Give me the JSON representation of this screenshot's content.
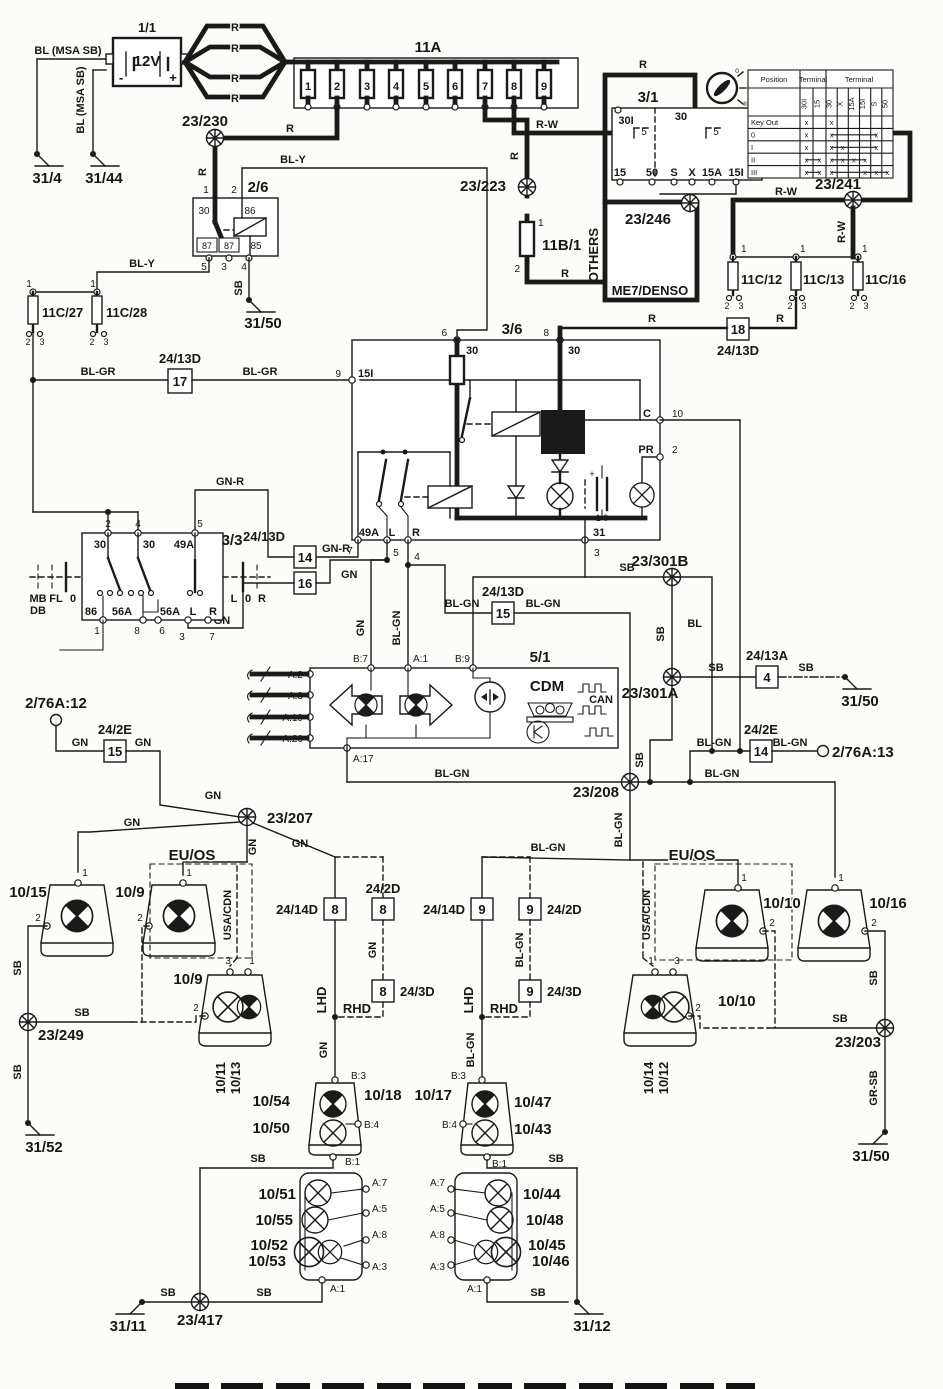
{
  "comp": {
    "battery": "1/1",
    "volt": "12V",
    "minus": "-",
    "plus": "+",
    "fusebox": "11A",
    "ign": "3/1",
    "b111": "11B/1",
    "others": "OTHERS",
    "me7": "ME7/DENSO",
    "c12": "11C/12",
    "c13": "11C/13",
    "c16": "11C/16",
    "c27": "11C/27",
    "c28": "11C/28",
    "relay": "2/6",
    "flasher": "3/6",
    "stalk": "3/3",
    "cdm_id": "5/1",
    "cdm": "CDM",
    "can": "CAN",
    "a12": "2/76A:12",
    "a13": "2/76A:13"
  },
  "w": {
    "r": "R",
    "rw": "R-W",
    "bly": "BL-Y",
    "blgr": "BL-GR",
    "gnr": "GN-R",
    "gn": "GN",
    "blgn": "BL-GN",
    "sb": "SB",
    "bl": "BL",
    "grsb": "GR-SB",
    "blmsa": "BL (MSA SB)"
  },
  "sp": {
    "s230": "23/230",
    "s223": "23/223",
    "s241": "23/241",
    "s246": "23/246",
    "s301b": "23/301B",
    "s301a": "23/301A",
    "s207": "23/207",
    "s208": "23/208",
    "s249": "23/249",
    "s203": "23/203",
    "s417": "23/417"
  },
  "g": {
    "g4": "31/4",
    "g44": "31/44",
    "g50": "31/50",
    "g52": "31/52",
    "g11": "31/11",
    "g12": "31/12"
  },
  "cn": {
    "c2413d": "24/13D",
    "c2413a": "24/13A",
    "c242e": "24/2E",
    "c2414d": "24/14D",
    "c242d": "24/2D",
    "c243d": "24/3D",
    "p4": "4",
    "p8": "8",
    "p9": "9",
    "p14": "14",
    "p15": "15",
    "p16": "16",
    "p17": "17",
    "p18": "18"
  },
  "pn": {
    "n1": "1",
    "n2": "2",
    "n3": "3",
    "n4": "4",
    "n5": "5",
    "n6": "6",
    "n7": "7",
    "n8": "8",
    "n9": "9",
    "n10": "10",
    "n30": "30",
    "n31": "31",
    "n86": "86",
    "n87": "87",
    "n85": "85",
    "n49a": "49A",
    "n56a": "56A",
    "n15i": "15I",
    "l": "L",
    "r": "R",
    "c": "C",
    "pr": "PR",
    "cap": "1 0",
    "mb": "MB",
    "db": "DB",
    "fl": "FL",
    "zero": "0"
  },
  "cdmp": {
    "a1": "A:1",
    "a2": "A:2",
    "a3": "A:3",
    "a19": "A:19",
    "a20": "A:20",
    "b7": "B:7",
    "b9": "B:9",
    "a17": "A:17",
    "b3": "B:3",
    "b4": "B:4",
    "b1": "B:1",
    "a5": "A:5",
    "a7": "A:7",
    "a8": "A:8"
  },
  "lp": {
    "l1015": "10/15",
    "l109": "10/9",
    "l1011": "10/11",
    "l1013": "10/13",
    "l1010": "10/10",
    "l1016": "10/16",
    "l1014": "10/14",
    "l1012": "10/12",
    "l1054": "10/54",
    "l1050": "10/50",
    "l1018": "10/18",
    "l1017": "10/17",
    "l1047": "10/47",
    "l1043": "10/43",
    "l1051": "10/51",
    "l1055": "10/55",
    "l1052": "10/52",
    "l1053": "10/53",
    "l1044": "10/44",
    "l1048": "10/48",
    "l1045": "10/45",
    "l1046": "10/46"
  },
  "mkt": {
    "euos": "EU/OS",
    "usacdn": "USA/CDN",
    "lhd": "LHD",
    "rhd": "RHD"
  },
  "ign": {
    "terms": {
      "t30i": "30I",
      "t30": "30",
      "t5": "5",
      "t15": "15",
      "t50": "50",
      "s": "S",
      "x": "X",
      "t15a": "15A",
      "t15i": "15I"
    },
    "table": {
      "position": "Position",
      "terminal": "Terminal",
      "mark": "x",
      "rows": {
        "keyout": "Key Out",
        "r0": "0",
        "r1": "I",
        "r2": "II",
        "r3": "III"
      },
      "cols1": [
        "30I",
        "15"
      ],
      "cols2": [
        "30",
        "X",
        "15A",
        "15I",
        "S",
        "50"
      ],
      "marks": {
        "keyout": {
          "t1": [
            1,
            0
          ],
          "t2": [
            1,
            0,
            0,
            0,
            0,
            0
          ]
        },
        "r0": {
          "t1": [
            1,
            0
          ],
          "t2": [
            1,
            0,
            0,
            0,
            1,
            0
          ]
        },
        "r1": {
          "t1": [
            1,
            0
          ],
          "t2": [
            1,
            1,
            0,
            0,
            1,
            0
          ]
        },
        "r2": {
          "t1": [
            1,
            1
          ],
          "t2": [
            1,
            1,
            1,
            1,
            0,
            0
          ]
        },
        "r3": {
          "t1": [
            1,
            1
          ],
          "t2": [
            1,
            0,
            0,
            1,
            1,
            1
          ]
        }
      }
    }
  }
}
